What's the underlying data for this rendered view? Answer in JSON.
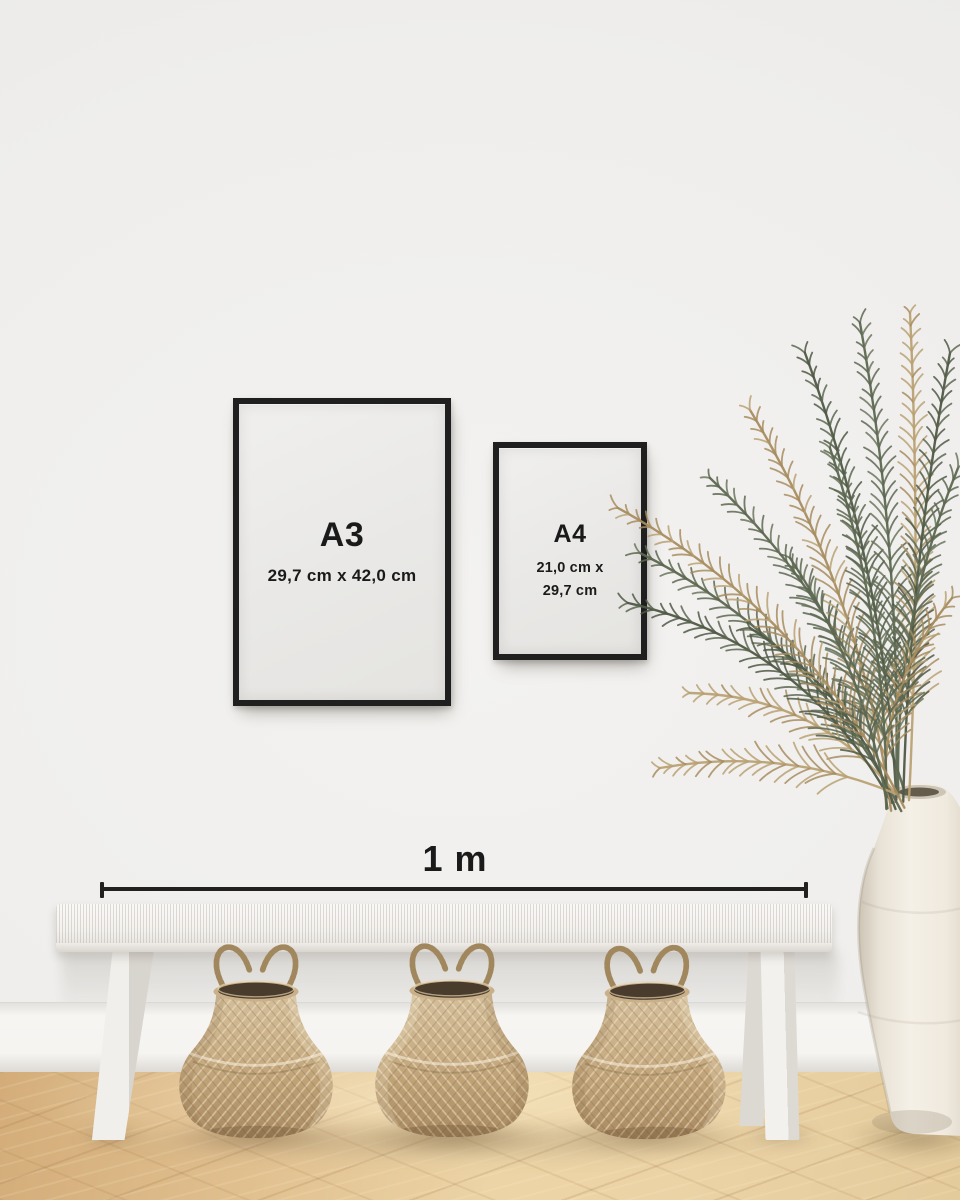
{
  "frames": {
    "a3": {
      "label": "A3",
      "dimensions": "29,7 cm x 42,0 cm"
    },
    "a4": {
      "label": "A4",
      "dimensions_line1": "21,0 cm x",
      "dimensions_line2": "29,7 cm"
    }
  },
  "measurement": {
    "label": "1 m"
  },
  "palette": {
    "wall": "#efeeec",
    "baseboard": "#f5f4f1",
    "frame": "#1f1f1f",
    "paper": "#ebeae8",
    "text": "#1a1a1a",
    "measure_line": "#22211f",
    "bench": "#f4f2ef",
    "floor_light": "#ecd4a6",
    "floor_dark": "#d9b384",
    "basket_light": "#d4bf9c",
    "basket_dark": "#a98a61",
    "basket_interior": "#4a3c2c",
    "plant_green": "#5c6750",
    "plant_tan": "#a78c5f",
    "vase": "#f2ede4"
  }
}
